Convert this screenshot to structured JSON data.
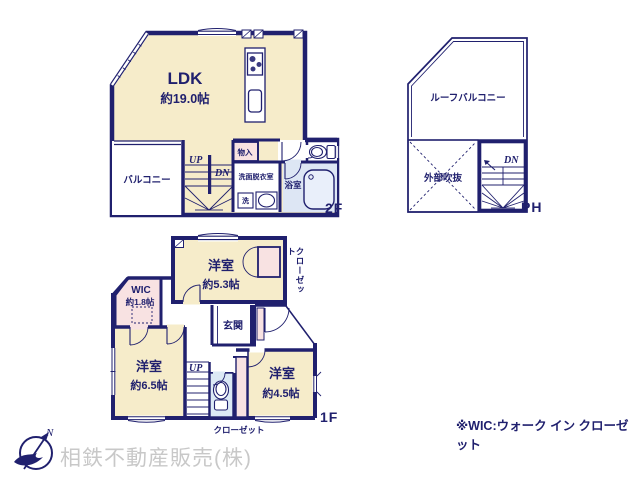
{
  "colors": {
    "wall_navy": "#20206E",
    "room_cream": "#F6ECCA",
    "closet_pink": "#F8E2E2",
    "bath_blue": "#DDE6F4",
    "toilet_blue": "#DCE9F5",
    "company_gray": "#C8C8C8"
  },
  "floor_2f": {
    "label": "2F",
    "ldk_name": "LDK",
    "ldk_size": "約19.0帖",
    "balcony": "バルコニー",
    "storage": "物入",
    "washroom": "洗面脱衣室",
    "laundry": "洗",
    "bath": "浴室",
    "up": "UP",
    "down": "DN"
  },
  "floor_ph": {
    "label": "PH",
    "roof_balcony": "ルーフバルコニー",
    "void": "外部吹抜",
    "down": "DN"
  },
  "floor_1f": {
    "label": "1F",
    "bedroom1_name": "洋室",
    "bedroom1_size": "約5.3帖",
    "closet1": "クローゼット",
    "wic_name": "WIC",
    "wic_size": "約1.8帖",
    "entrance": "玄関",
    "bedroom2_name": "洋室",
    "bedroom2_size": "約6.5帖",
    "bedroom3_name": "洋室",
    "bedroom3_size": "約4.5帖",
    "closet2": "クローゼット",
    "up": "UP"
  },
  "footer": {
    "compass_north": "N",
    "company": "相鉄不動産販売(株)",
    "wic_note": "※WIC:ウォーク イン クローゼット"
  }
}
